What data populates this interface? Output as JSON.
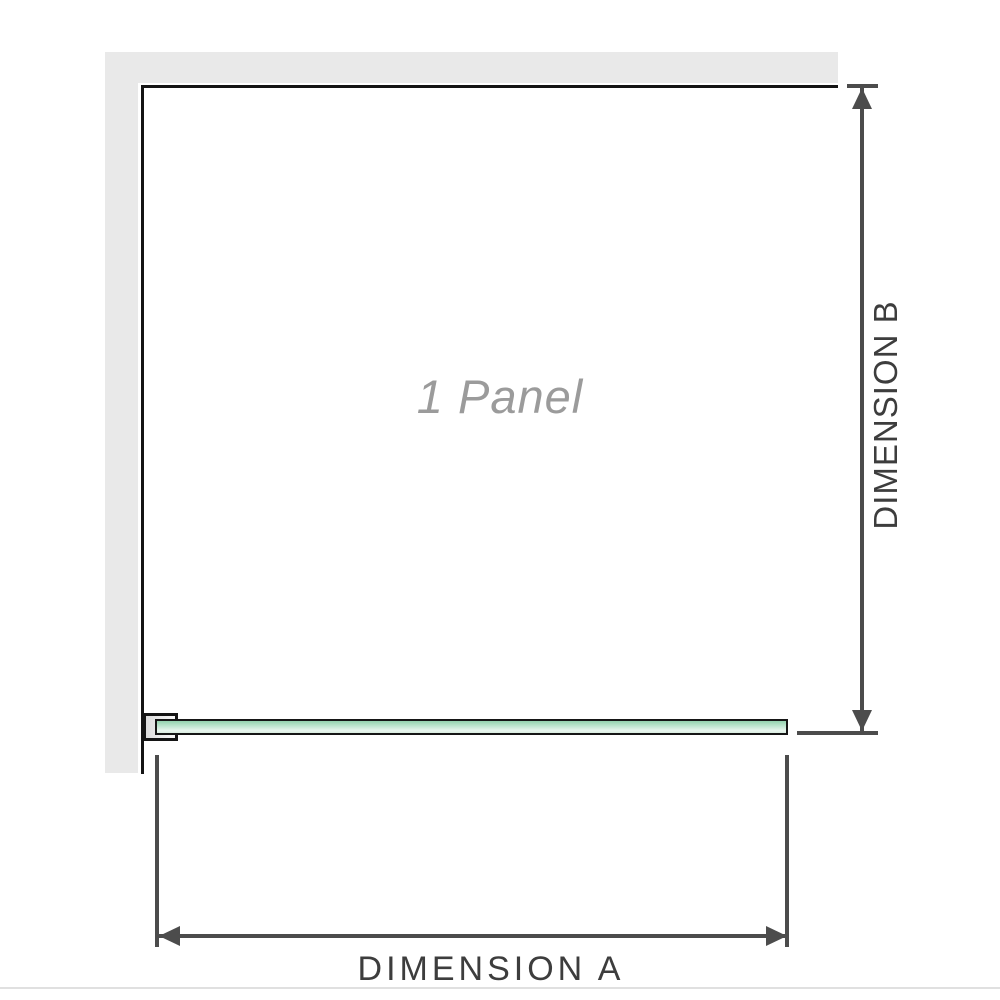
{
  "diagram": {
    "labels": {
      "panel": "1 Panel",
      "dimension_a": "DIMENSION A",
      "dimension_b": "DIMENSION B"
    },
    "colors": {
      "background": "#ffffff",
      "wall_fill": "#e9e9e9",
      "enclosure_outline": "#141414",
      "glass_fill_top": "#93d2ae",
      "glass_fill_bottom": "#e9f6ef",
      "glass_border": "#161616",
      "bracket_fill": "#e4e4e4",
      "dimension_line": "#4c4c4c",
      "dimension_label_text": "#3d3d3d",
      "panel_label_text": "#9b9b9b",
      "bottom_divider": "#e0e0e0"
    }
  }
}
